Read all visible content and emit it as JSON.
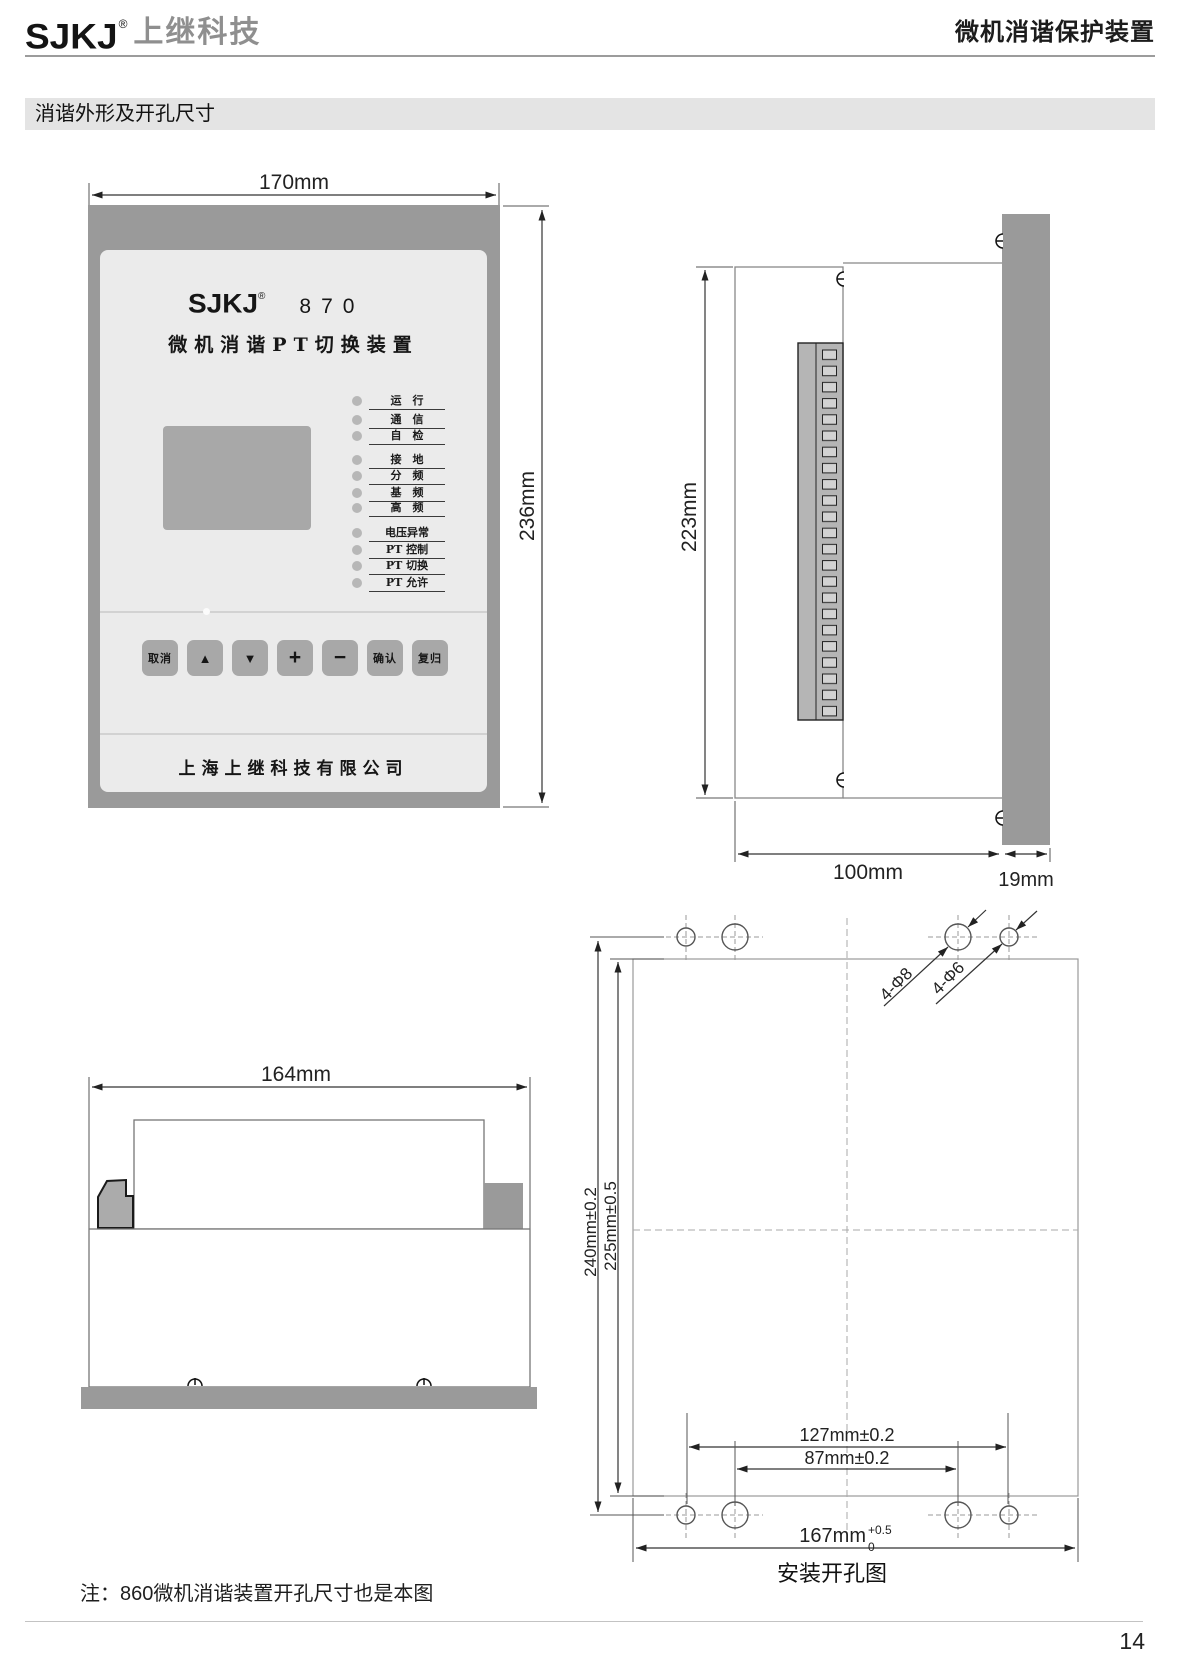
{
  "header": {
    "brand": "SJKJ",
    "reg": "®",
    "brand_cn": "上继科技",
    "doc_title": "微机消谐保护装置"
  },
  "section": {
    "title": "消谐外形及开孔尺寸"
  },
  "front_view": {
    "dim_width": "170mm",
    "dim_height": "236mm",
    "panel": {
      "brand": "SJKJ",
      "reg": "®",
      "model": "870",
      "title": "微机消谐PT切换装置",
      "leds": [
        "运　行",
        "通　信",
        "自　检",
        "接　地",
        "分　频",
        "基　频",
        "高　频",
        "电压异常",
        "PT 控制",
        "PT 切换",
        "PT 允许"
      ],
      "buttons": [
        "取消",
        "▲",
        "▼",
        "+",
        "−",
        "确认",
        "复归"
      ],
      "company": "上海上继科技有限公司"
    }
  },
  "side_view": {
    "dim_height": "223mm",
    "dim_depth": "100mm",
    "dim_bezel": "19mm"
  },
  "top_view": {
    "dim_width": "164mm"
  },
  "install_view": {
    "dim_v_outer": "240mm±0.2",
    "dim_v_inner": "225mm±0.5",
    "dim_h_outer": "127mm±0.2",
    "dim_h_inner": "87mm±0.2",
    "dim_total": "167mm",
    "dim_total_sup": "+0.5",
    "dim_total_sub": "0",
    "label_large_holes": "4-Φ8",
    "label_small_holes": "4-Φ6",
    "caption": "安装开孔图"
  },
  "note": "注：860微机消谐装置开孔尺寸也是本图",
  "page_number": "14",
  "colors": {
    "case_gray": "#9a9a9a",
    "panel_gray": "#ebebeb",
    "control_gray": "#a8a8a8"
  }
}
